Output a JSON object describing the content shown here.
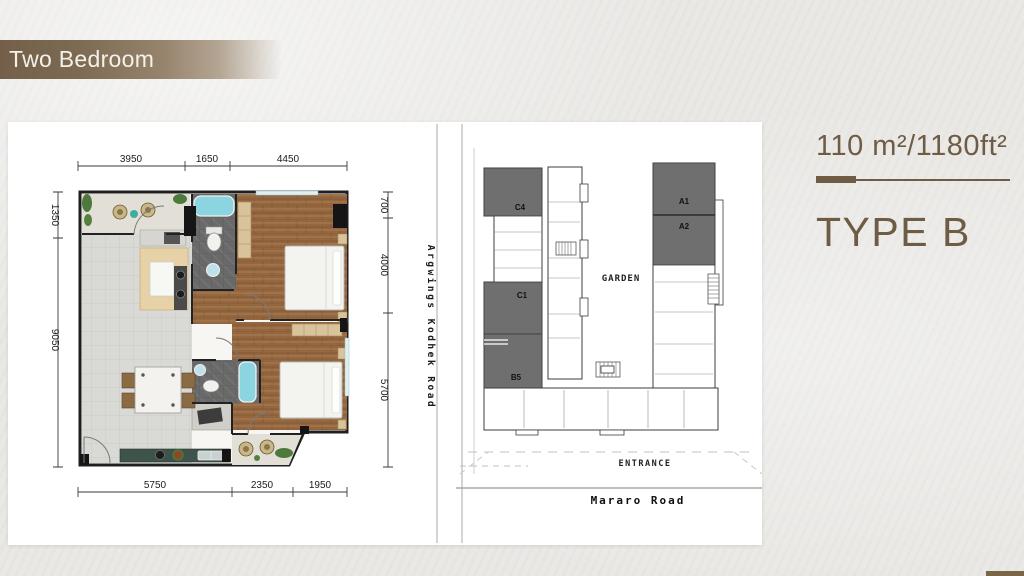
{
  "banner": {
    "title": "Two Bedroom"
  },
  "info": {
    "area": "110 m²/1180ft²",
    "type": "TYPE B",
    "accent_color": "#6f5c45"
  },
  "floor_plan": {
    "dim_top_1": "3950",
    "dim_top_2": "1650",
    "dim_top_3": "4450",
    "dim_bottom_1": "5750",
    "dim_bottom_2": "2350",
    "dim_bottom_3": "1950",
    "dim_left_1": "1350",
    "dim_left_2": "9050",
    "dim_right_1": "700",
    "dim_right_2": "4000",
    "dim_right_3": "5700",
    "road_vertical": "Argwings Kodhek Road"
  },
  "site_plan": {
    "unit_c4": "C4",
    "unit_c1": "C1",
    "unit_b5": "B5",
    "unit_a1": "A1",
    "unit_a2": "A2",
    "garden": "GARDEN",
    "entrance": "ENTRANCE",
    "road": "Mararo Road",
    "highlight_color": "#6f6f6f"
  }
}
